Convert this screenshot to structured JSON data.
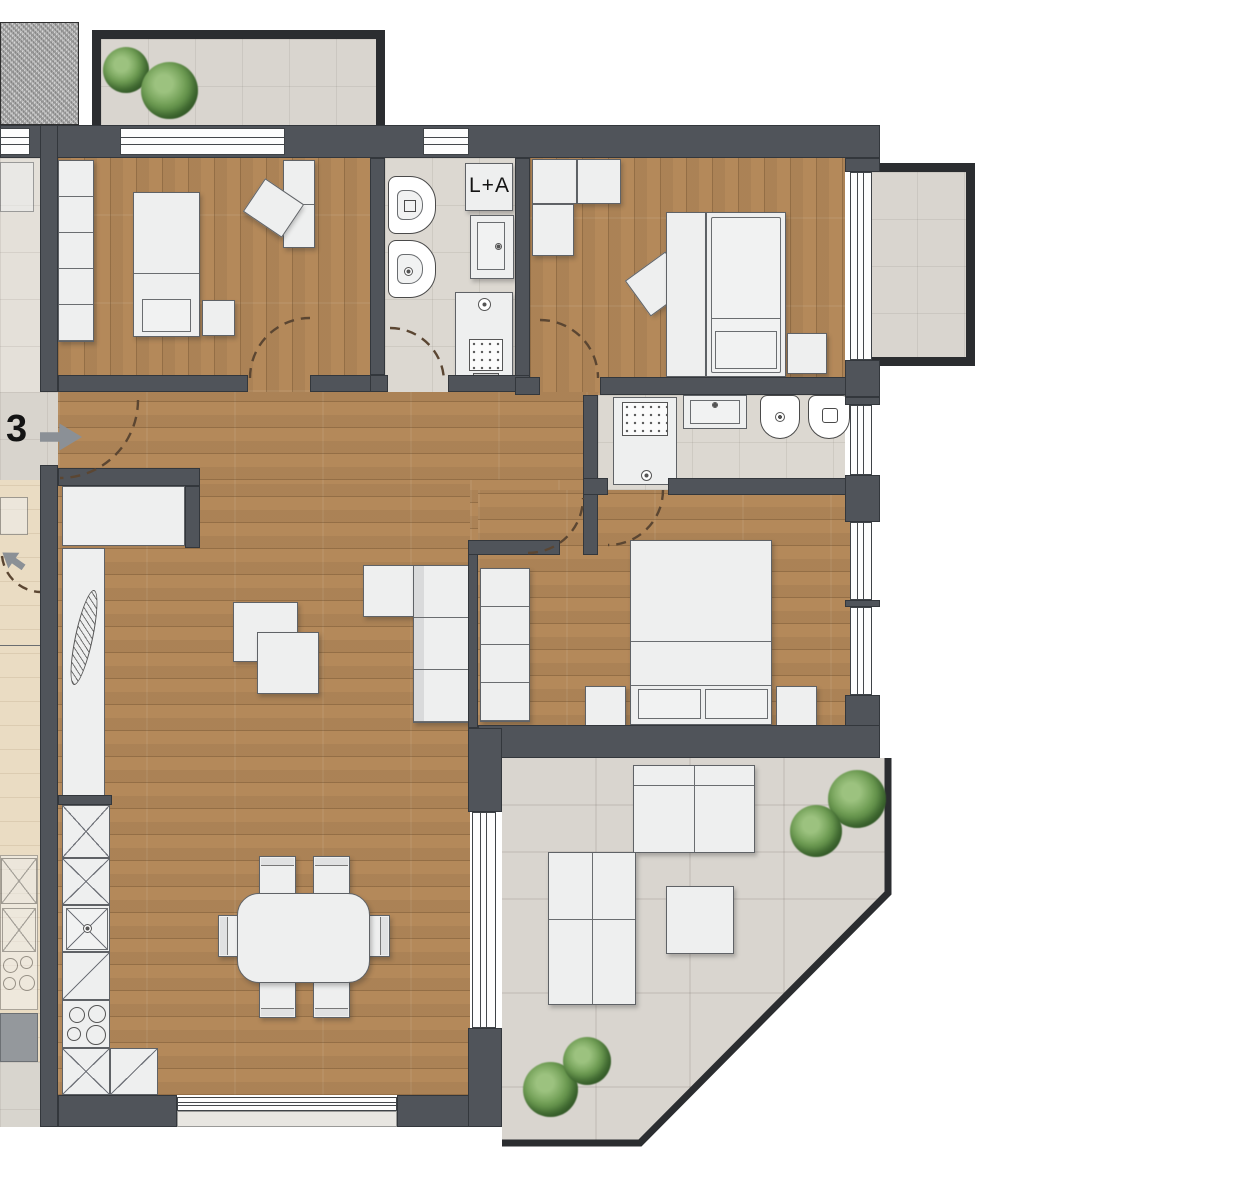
{
  "labels": {
    "unit_number": "3",
    "laundry_appliances": "L+A"
  },
  "palette": {
    "wall": "#50545a",
    "railing": "#2b2d30",
    "wood_floor": "#b4895a",
    "bath_tile": "#dcd8d1",
    "terrace_tile": "#d9d5cf",
    "furniture": "#eeefef",
    "plant_green": "#5d8f46",
    "entry_arrow_gray": "#8b9096",
    "door_arc_brown": "#5b4632",
    "gravel_gray": "#bdbdbd",
    "neighbor_floor": "#eadcc3"
  }
}
